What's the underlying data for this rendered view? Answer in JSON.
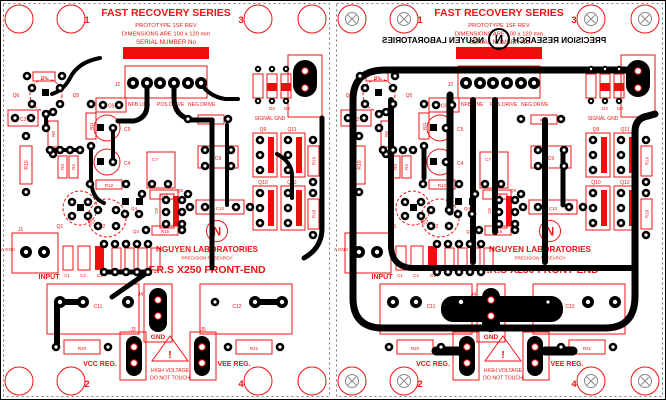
{
  "colors": {
    "board_background": "#ffffff",
    "silkscreen_red": "#ee1414",
    "copper_black": "#000000",
    "serial_bar_red": "#ee0e0e"
  },
  "header": {
    "title": "FAST RECOVERY SERIES",
    "prototype": "PROTOTYPE 1SF REV",
    "dimensions": "DIMENSIONS ARE  100 x 120 mm",
    "serial": "SERIAL NUMBER No"
  },
  "brand": {
    "logo_letter": "N",
    "company": "NGUYEN LABORATORIES",
    "division": "PRECISION RESEARCH",
    "product": "F.R.S X250 FRONT-END"
  },
  "corner_numbers": {
    "n1": "1",
    "n2": "2",
    "n3": "3",
    "n4": "4"
  },
  "labels": {
    "nfb_line": "NFB LINE",
    "pos_drive": "POS DRIVE",
    "neg_drive": "NEG DRIVE",
    "signal_gnd": "SIGNAL GND",
    "a_gnd": "A GND",
    "input": "INPUT",
    "gnd": "GND",
    "vcc_reg": "VCC REG.",
    "vee_reg": "VEE REG."
  },
  "warning": {
    "line1": "HIGH VOLTAGE",
    "line2": "DO NOT TOUCH",
    "mark": "!"
  },
  "refs": {
    "j1": "J1",
    "j2": "J2",
    "j3": "J3",
    "j4": "J4",
    "j5": "J5",
    "q1": "Q1",
    "q2": "Q2",
    "q3": "Q3",
    "q4": "Q4",
    "q5": "Q5",
    "q6": "Q6",
    "q7": "Q7",
    "q8": "Q8",
    "q9": "Q9",
    "q10": "Q10",
    "q11": "Q11",
    "q12": "Q12",
    "r3": "R3",
    "r4": "R4",
    "r8": "R8",
    "r9": "R9",
    "r10": "R10",
    "r11": "R11",
    "r12": "R12",
    "r14": "R14",
    "r15": "R15",
    "r16": "R16",
    "r18": "R18",
    "r19": "R19",
    "r20": "R20",
    "r21": "R21",
    "c1": "C1",
    "c2": "C2",
    "c3": "C3",
    "c4": "C4",
    "c5": "C5",
    "c6": "C6",
    "c7": "C7",
    "c8": "C8",
    "c9": "C9",
    "c10": "C10",
    "c11": "C11",
    "c12": "C12",
    "d1": "D1",
    "d2": "D2",
    "d3": "D3"
  }
}
